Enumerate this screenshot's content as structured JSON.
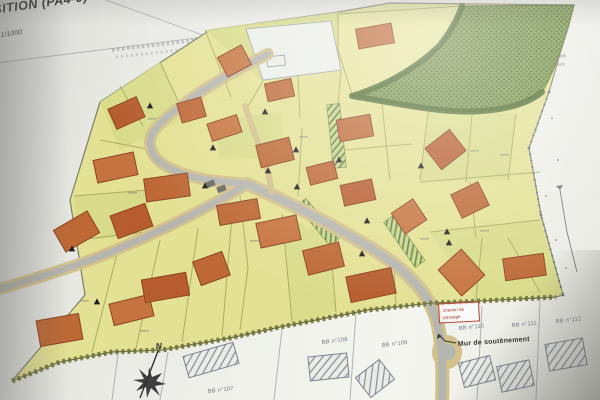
{
  "title_block": {
    "title": "SITION (PA4-9)",
    "scale": "1/1000"
  },
  "compass": {
    "north_label": "N"
  },
  "annotations": {
    "wall_label": "Mur de soutènement",
    "passage_box_line1": "chemin de",
    "passage_box_line2": "passage"
  },
  "neighbor_parcels": [
    {
      "label": "BB n°107",
      "x": 208,
      "y": 393,
      "r": -7
    },
    {
      "label": "BB n°108",
      "x": 322,
      "y": 344,
      "r": -7
    },
    {
      "label": "BB n°109",
      "x": 382,
      "y": 347,
      "r": -7
    },
    {
      "label": "BB n°110",
      "x": 459,
      "y": 330,
      "r": -6
    },
    {
      "label": "BB n°111",
      "x": 512,
      "y": 327,
      "r": -6
    },
    {
      "label": "BB n°112",
      "x": 556,
      "y": 323,
      "r": -6
    }
  ],
  "plan": {
    "buildings": [
      {
        "x": 357,
        "y": 26,
        "w": 36,
        "h": 20,
        "r": -10,
        "t": 0
      },
      {
        "x": 221,
        "y": 50,
        "w": 27,
        "h": 22,
        "r": -28,
        "t": 1
      },
      {
        "x": 266,
        "y": 81,
        "w": 27,
        "h": 18,
        "r": -12,
        "t": 0
      },
      {
        "x": 111,
        "y": 102,
        "w": 31,
        "h": 22,
        "r": -24,
        "t": 2
      },
      {
        "x": 179,
        "y": 100,
        "w": 25,
        "h": 20,
        "r": -16,
        "t": 0
      },
      {
        "x": 209,
        "y": 119,
        "w": 31,
        "h": 18,
        "r": -18,
        "t": 1
      },
      {
        "x": 338,
        "y": 117,
        "w": 34,
        "h": 22,
        "r": -10,
        "t": 0
      },
      {
        "x": 430,
        "y": 136,
        "w": 31,
        "h": 27,
        "r": -38,
        "t": 2
      },
      {
        "x": 258,
        "y": 141,
        "w": 34,
        "h": 23,
        "r": -14,
        "t": 0
      },
      {
        "x": 95,
        "y": 156,
        "w": 41,
        "h": 23,
        "r": -12,
        "t": 1
      },
      {
        "x": 308,
        "y": 164,
        "w": 28,
        "h": 18,
        "r": -14,
        "t": 0
      },
      {
        "x": 145,
        "y": 176,
        "w": 44,
        "h": 23,
        "r": -8,
        "t": 0
      },
      {
        "x": 342,
        "y": 182,
        "w": 32,
        "h": 21,
        "r": -12,
        "t": 2
      },
      {
        "x": 455,
        "y": 187,
        "w": 30,
        "h": 26,
        "r": -26,
        "t": 0
      },
      {
        "x": 396,
        "y": 204,
        "w": 26,
        "h": 25,
        "r": -34,
        "t": 1
      },
      {
        "x": 218,
        "y": 202,
        "w": 41,
        "h": 20,
        "r": -10,
        "t": 0
      },
      {
        "x": 113,
        "y": 209,
        "w": 37,
        "h": 24,
        "r": -20,
        "t": 2
      },
      {
        "x": 57,
        "y": 219,
        "w": 39,
        "h": 25,
        "r": -30,
        "t": 0
      },
      {
        "x": 258,
        "y": 219,
        "w": 41,
        "h": 25,
        "r": -12,
        "t": 1
      },
      {
        "x": 305,
        "y": 246,
        "w": 37,
        "h": 25,
        "r": -14,
        "t": 0
      },
      {
        "x": 348,
        "y": 272,
        "w": 46,
        "h": 26,
        "r": -12,
        "t": 2
      },
      {
        "x": 196,
        "y": 256,
        "w": 31,
        "h": 25,
        "r": -20,
        "t": 0
      },
      {
        "x": 446,
        "y": 255,
        "w": 31,
        "h": 35,
        "r": -42,
        "t": 1
      },
      {
        "x": 504,
        "y": 256,
        "w": 41,
        "h": 22,
        "r": -8,
        "t": 0
      },
      {
        "x": 38,
        "y": 317,
        "w": 43,
        "h": 26,
        "r": -10,
        "t": 0
      },
      {
        "x": 111,
        "y": 299,
        "w": 41,
        "h": 22,
        "r": -14,
        "t": 1
      },
      {
        "x": 143,
        "y": 276,
        "w": 45,
        "h": 23,
        "r": -10,
        "t": 2
      }
    ],
    "access_markers": [
      {
        "x": 150,
        "y": 106
      },
      {
        "x": 265,
        "y": 112
      },
      {
        "x": 213,
        "y": 148
      },
      {
        "x": 296,
        "y": 150
      },
      {
        "x": 268,
        "y": 171
      },
      {
        "x": 297,
        "y": 187
      },
      {
        "x": 205,
        "y": 186
      },
      {
        "x": 339,
        "y": 160
      },
      {
        "x": 421,
        "y": 166
      },
      {
        "x": 447,
        "y": 232
      },
      {
        "x": 449,
        "y": 243
      },
      {
        "x": 367,
        "y": 221
      },
      {
        "x": 362,
        "y": 254
      },
      {
        "x": 72,
        "y": 249
      },
      {
        "x": 97,
        "y": 302
      }
    ],
    "existing_buildings": [
      {
        "x": 185,
        "y": 349,
        "w": 52,
        "h": 22,
        "r": -16
      },
      {
        "x": 309,
        "y": 355,
        "w": 39,
        "h": 24,
        "r": -6
      },
      {
        "x": 360,
        "y": 366,
        "w": 30,
        "h": 25,
        "r": -38
      },
      {
        "x": 461,
        "y": 359,
        "w": 32,
        "h": 25,
        "r": -14
      },
      {
        "x": 499,
        "y": 363,
        "w": 33,
        "h": 26,
        "r": -12
      },
      {
        "x": 547,
        "y": 341,
        "w": 38,
        "h": 27,
        "r": -10
      }
    ]
  },
  "colors": {
    "building_tones": [
      "#c4662e",
      "#cd7338",
      "#bd5a28"
    ],
    "building_stroke": "#93411c",
    "parcel_yellow": "#e6e38e",
    "parcel_green": "#d8de83",
    "road_tan": "#d5c287",
    "road_gray": "#b6b7af",
    "green_area": "#7d9a48",
    "hedge": "#42631f",
    "marker": "#1c1c1c",
    "label_red": "#c0392b",
    "hatch_stroke": "#7e8490"
  }
}
